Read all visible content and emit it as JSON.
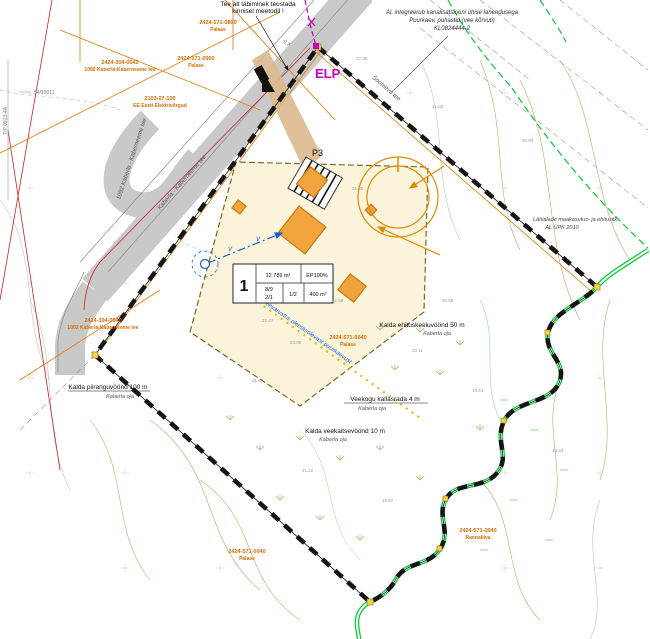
{
  "notes": {
    "crossing": {
      "line1": "Tee alt läbiminek teostada",
      "line2": "kinnisel meetodil !"
    },
    "access": {
      "line1": "Al. integreerub kanalisatsiooni ühise lahendusega",
      "line2": "Puurkaev, puhastid (vee kõrvuti)",
      "line3": "KL0824444-2"
    },
    "vicinity": {
      "line1": "Lähialade maakasutus- ja ehituslik",
      "line2": "AL ÜPK 2010"
    },
    "water": "Veevarustus olemasolevast puurkaevust"
  },
  "markers": {
    "elp": "ELP",
    "p3": "P3",
    "road_width": "0.7",
    "water_v": "V"
  },
  "plot_table": {
    "number": "1",
    "area": "12 789 m²",
    "usage": "EP100%",
    "r1": "8/9",
    "r2": "2/1",
    "ratio": "1/2",
    "max_area": "400 m²"
  },
  "roads": {
    "label1": "1092 Kaberla - Kaberneeme tee",
    "label2": "Kaberla - Kaberneeme tee",
    "label3": "Sooteeva tee"
  },
  "cadastral_labels": [
    {
      "id": "2424-304-0042",
      "name": "1092 Kaberla-Kaberneeme tee"
    },
    {
      "id": "2424-571-0890",
      "name": "Palase"
    },
    {
      "id": "2424-571-0900",
      "name": "Palase"
    },
    {
      "id": "2103-07-100",
      "name": "EE Eesti Elektrivõrgud"
    },
    {
      "id": "2424-304-0040",
      "name": "1002 Kaberla-Kaberneeme tee"
    },
    {
      "id": "2424-571-0040",
      "name": "Palase"
    },
    {
      "id": "2424-571-0040",
      "name": "Rannaliiva"
    },
    {
      "id": "2424-571-0040",
      "name": "Palase"
    }
  ],
  "protection_labels": [
    {
      "title": "Kalda piiranguvöönd 100 m",
      "sub": "Kaberla oja"
    },
    {
      "title": "Kalda ehituskeeluvöönd 50 m",
      "sub": "Kaberla oja"
    },
    {
      "title": "Veekogu kallasrada 4 m",
      "sub": "Kaberla oja"
    },
    {
      "title": "Kalda veekaitsevöönd 10 m",
      "sub": "Kaberla oja"
    }
  ],
  "margin_marks": {
    "vertical": "T/P 0913-4A",
    "horizontal": "54/15011"
  },
  "elevations": [
    "21.35",
    "21.85",
    "20.93",
    "27.35",
    "22.47",
    "23.08",
    "21.67",
    "22.59",
    "20.11",
    "19.44",
    "21.22",
    "19.87",
    "20.56",
    "18.93"
  ],
  "colors": {
    "boundary": "#151515",
    "stream": "#00cc33",
    "cadastral": "#d96c00",
    "building_fill": "#f2a33c",
    "building_stroke": "#c97a1a",
    "zone_fill": "#fcf4da",
    "road_fill": "#c9c9c9",
    "magenta": "#c400c4",
    "water_blue": "#1560d4",
    "red_line": "#cc2222"
  }
}
